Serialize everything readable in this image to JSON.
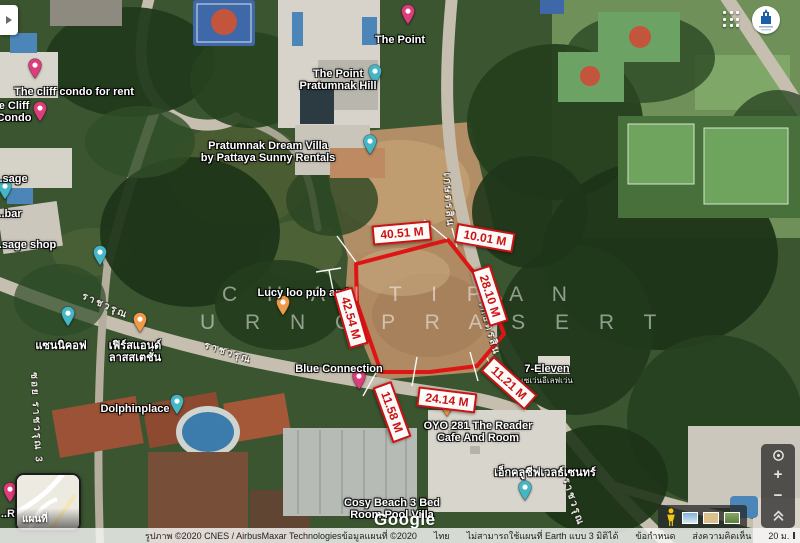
{
  "ui": {
    "watermark_line1": "C H A I T I P A N",
    "watermark_line2": "U R N G P R A S E R T",
    "google_logo": "Google",
    "map_type_label": "แผนที่",
    "zoom_in": "+",
    "zoom_out": "−",
    "attribution": {
      "imagery": "รูปภาพ ©2020 CNES / AirbusMaxar Technologiesข้อมูลแผนที่ ©2020",
      "region": "ไทย",
      "notice": "ไม่สามารถใช้แผนที่ Earth แบบ 3 มิติได้",
      "terms": "ข้อกำหนด",
      "feedback": "ส่งความคิดเห็น",
      "scale_label": "20 ม."
    }
  },
  "polygon": {
    "color": "#de1515",
    "points": "356,264 448,240 487,289 504,334 477,366 430,372 381,372 357,303"
  },
  "measurements": [
    {
      "text": "40.51 M",
      "x": 402,
      "y": 233,
      "rot": -5
    },
    {
      "text": "10.01 M",
      "x": 485,
      "y": 238,
      "rot": 10
    },
    {
      "text": "28.10 M",
      "x": 490,
      "y": 296,
      "rot": 72
    },
    {
      "text": "42.54 M",
      "x": 351,
      "y": 318,
      "rot": 74
    },
    {
      "text": "11.58 M",
      "x": 392,
      "y": 412,
      "rot": 70
    },
    {
      "text": "24.14 M",
      "x": 447,
      "y": 400,
      "rot": 7
    },
    {
      "text": "11.21 M",
      "x": 509,
      "y": 383,
      "rot": 42
    }
  ],
  "pin_colors": {
    "pink": "#dd3d7b",
    "teal": "#45b6c4",
    "orange": "#ef9a49"
  },
  "places": [
    {
      "lines": [
        "The cliff condo for rent"
      ],
      "x": 74,
      "y": 92,
      "pin": {
        "color": "pink",
        "x": 35,
        "y": 84
      }
    },
    {
      "lines": [
        "e Cliff",
        "Condo"
      ],
      "x": 14,
      "y": 112,
      "pin": {
        "color": "pink",
        "x": 40,
        "y": 127
      }
    },
    {
      "lines": [
        "The Point"
      ],
      "x": 400,
      "y": 40,
      "pin": {
        "color": "pink",
        "x": 408,
        "y": 30
      }
    },
    {
      "lines": [
        "The Point",
        "Pratumnak Hill"
      ],
      "x": 338,
      "y": 80,
      "pin": {
        "color": "teal",
        "x": 375,
        "y": 90
      }
    },
    {
      "lines": [
        "Pratumnak Dream Villa",
        "by Pattaya Sunny Rentals"
      ],
      "x": 268,
      "y": 152,
      "pin": {
        "color": "teal",
        "x": 370,
        "y": 160
      }
    },
    {
      "lines": [
        "..sage"
      ],
      "x": 12,
      "y": 179,
      "pin": {
        "color": "teal",
        "x": 5,
        "y": 205
      }
    },
    {
      "lines": [
        "..bar"
      ],
      "x": 10,
      "y": 214
    },
    {
      "lines": [
        "..sage shop"
      ],
      "x": 26,
      "y": 245,
      "pin": {
        "color": "teal",
        "x": 100,
        "y": 271
      }
    },
    {
      "lines": [
        "แซนนิคอฟ"
      ],
      "x": 61,
      "y": 346,
      "pin": {
        "color": "teal",
        "x": 68,
        "y": 332
      }
    },
    {
      "lines": [
        "เฟิร์สแอนด์",
        "ลาสสเตชั่น"
      ],
      "x": 135,
      "y": 352,
      "pin": {
        "color": "orange",
        "x": 140,
        "y": 338
      }
    },
    {
      "lines": [
        "Lucy loo pub and"
      ],
      "x": 303,
      "y": 293,
      "pin": {
        "color": "orange",
        "x": 283,
        "y": 321
      }
    },
    {
      "lines": [
        "Blue Connection"
      ],
      "x": 339,
      "y": 369,
      "pin": {
        "color": "pink",
        "x": 359,
        "y": 395
      }
    },
    {
      "lines": [
        "Dolphinplace"
      ],
      "x": 135,
      "y": 409,
      "pin": {
        "color": "teal",
        "x": 177,
        "y": 420
      }
    },
    {
      "lines": [
        "7-Eleven"
      ],
      "x": 547,
      "y": 375,
      "sub": "เซเว่นอีเลฟเว่น"
    },
    {
      "lines": [
        "OYO 281 The Reader",
        "Cafe And Room"
      ],
      "x": 478,
      "y": 432,
      "pin": {
        "color": "orange",
        "x": 447,
        "y": 422
      }
    },
    {
      "lines": [
        "เอ็กคลูซีฟเวลธ์เซนทร์"
      ],
      "x": 545,
      "y": 473
    },
    {
      "lines": [
        "Cosy Beach 3 Bed",
        "Room Pool Villa"
      ],
      "x": 392,
      "y": 509,
      "pin": {
        "color": "teal",
        "x": 525,
        "y": 506
      }
    },
    {
      "lines": [
        "..Res"
      ],
      "x": 14,
      "y": 514,
      "pin": {
        "color": "pink",
        "x": 10,
        "y": 508
      }
    }
  ],
  "streets": [
    {
      "text": "ราชวรุณ",
      "x": 105,
      "y": 306,
      "rot": 24
    },
    {
      "text": "ราชวรุณ",
      "x": 228,
      "y": 353,
      "rot": 18
    },
    {
      "text": "เกษตรสิน",
      "x": 448,
      "y": 200,
      "rot": 86
    },
    {
      "text": "เกษตรสิน",
      "x": 489,
      "y": 329,
      "rot": 74
    },
    {
      "text": "ราชวรุณ",
      "x": 573,
      "y": 502,
      "rot": 72
    },
    {
      "text": "ซอย ราชวรุณ 3",
      "x": 36,
      "y": 418,
      "rot": 87
    }
  ]
}
